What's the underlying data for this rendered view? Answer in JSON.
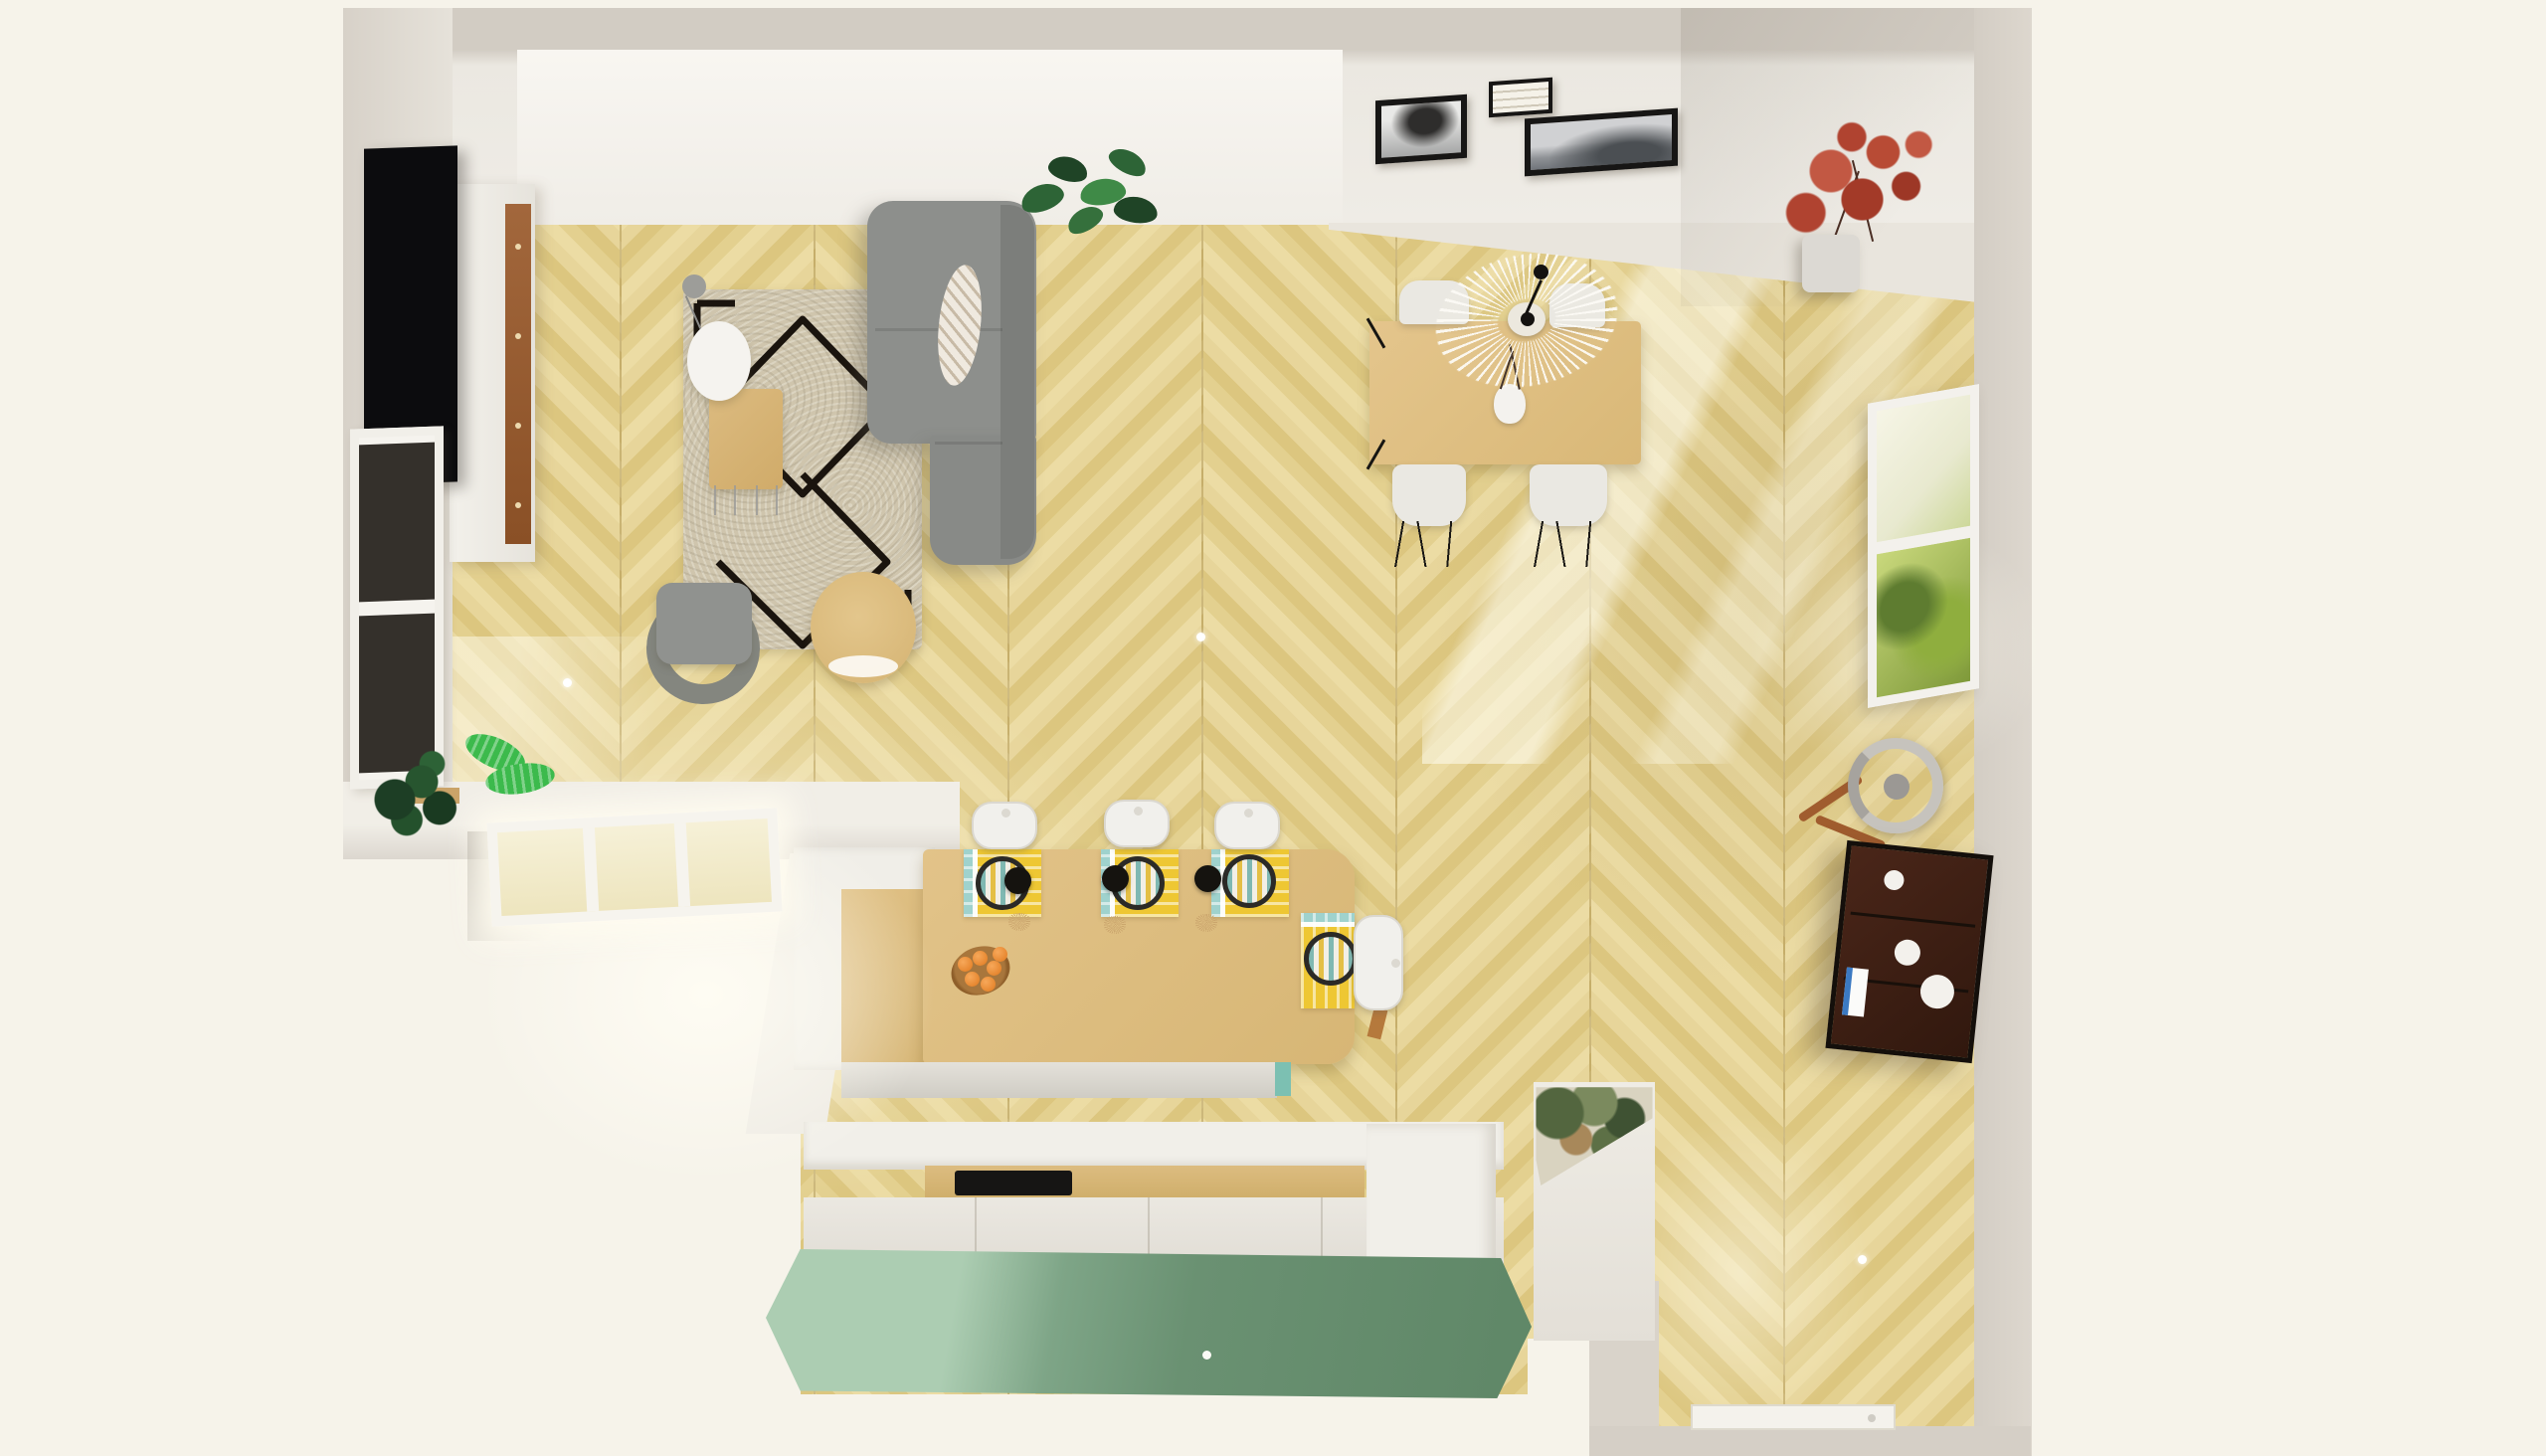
{
  "scene": {
    "title": "Top-down 3D render of an L-shaped open-plan living room, dining area and kitchen",
    "view": "top-down 3D floor plan",
    "flooring": "light oak chevron parquet",
    "background_color": "#f6f3ea"
  },
  "palette": {
    "outside": "#f6f3ea",
    "wall_top": "#d2ccc3",
    "wall_face": "#efece6",
    "floor_light": "#ecdca4",
    "floor_mid": "#e3d08f",
    "floor_dark": "#dcc67f",
    "sofa_gray": "#8d8f8c",
    "rug_beige": "#cfc5ad",
    "rug_pattern": "#1a140e",
    "wood_furniture": "#dcbb80",
    "island_wood": "#e0c186",
    "placemat_yellow": "#eec733",
    "placemat_teal": "#9fd2cd",
    "pendant_black": "#15130f",
    "green_sideboard": "#6a9172",
    "green_highlight": "#accdb2",
    "teal_accent": "#7cc0b2",
    "dark_shelf": "#31180e",
    "maple_red": "#b04330",
    "plant_green": "#27552f",
    "bright_leaf": "#3cba4c",
    "tv_black": "#0c0c0e",
    "walnut_strip": "#8a5026"
  },
  "living_room": {
    "tv": {
      "label": "Wall-mounted flat TV"
    },
    "tv_cabinet": {
      "label": "White media sideboard with walnut front and knobs"
    },
    "left_window": {
      "label": "Window in left wall"
    },
    "rug": {
      "label": "Beige berber rug with black diamond pattern"
    },
    "sofa": {
      "label": "Gray fabric sofa"
    },
    "pillow": {
      "label": "Patterned throw pillow"
    },
    "coffee_table": {
      "label": "Wooden coffee table with metal hairpin legs"
    },
    "side_table": {
      "label": "White round side table"
    },
    "floor_lamp": {
      "label": "Gray reading floor lamp"
    },
    "armchair": {
      "label": "Gray armchair"
    },
    "pouf": {
      "label": "Round wooden side table / pouf"
    },
    "monstera": {
      "label": "Monstera plant"
    }
  },
  "dining_area": {
    "table": {
      "label": "Light wood dining table"
    },
    "chairs": {
      "label": "White dining chair with black hairpin legs",
      "count": 4
    },
    "pendant": {
      "label": "White Vertigo-style pendant lamp"
    },
    "vase": {
      "label": "White vase with dry branches"
    },
    "frames": {
      "count": 3,
      "items": [
        {
          "label": "Black & white tree photo in black frame"
        },
        {
          "label": "Small framed script print"
        },
        {
          "label": "Wide foggy landscape photo in black frame"
        }
      ]
    },
    "corner_plant": {
      "label": "Red japanese maple in gray planter"
    },
    "garden_window": {
      "label": "Window in right wall with garden greenery"
    }
  },
  "kitchen": {
    "island": {
      "label": "Wooden kitchen island bar counter"
    },
    "stools": {
      "label": "White bar stool",
      "count": 4
    },
    "placemats": {
      "label": "Yellow striped placemat with black-rimmed plate",
      "count": 4
    },
    "pendants": {
      "label": "Black pendant light with rattan tassel",
      "count": 3
    },
    "fruit_bowl": {
      "label": "Wooden bowl with oranges",
      "orange_count": 6
    },
    "base_cabinets": {
      "label": "White base cabinets under island"
    },
    "counter": {
      "label": "Kitchen counter with wooden worktop"
    },
    "cooktop": {
      "label": "Black cooktop hob"
    },
    "tall_cabinet": {
      "label": "Tall white cabinet / fridge housing"
    },
    "green_sideboard": {
      "label": "Sage green sideboard along bottom wall"
    },
    "sun_window": {
      "label": "Sunlit mullioned window at kitchen corner"
    }
  },
  "hallway": {
    "dark_shelf": {
      "label": "Dark wood open shelving unit with dishes and bottles"
    },
    "mirror": {
      "label": "Round mirror decor with wooden legs"
    },
    "wallpaper_wall": {
      "label": "Wall section with botanical wallpaper"
    },
    "door": {
      "label": "White entrance door at hallway end"
    },
    "downlights": {
      "label": "Ceiling spotlight reflections on floor",
      "count": 3
    }
  }
}
